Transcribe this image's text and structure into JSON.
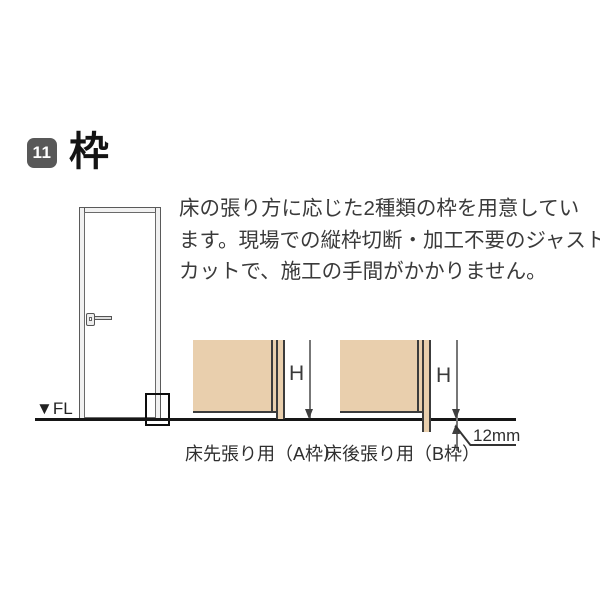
{
  "header": {
    "badge": "11",
    "title": "枠"
  },
  "intro": {
    "lines": [
      "床の張り方に応じた2種類の枠を用意してい",
      "ます。現場での縦枠切断・加工不要のジャスト",
      "カットで、施工の手間がかかりません。"
    ]
  },
  "floor": {
    "fl_label": "▼FL"
  },
  "diagram_a": {
    "label": "床先張り用（A枠）",
    "height_label": "H"
  },
  "diagram_b": {
    "label": "床後張り用（B枠）",
    "height_label": "H",
    "offset_label": "12mm"
  },
  "colors": {
    "wall-tan": "#e9cfad",
    "line-dark": "#3c3c3c",
    "floor-black": "#161616",
    "badge-gray": "#585858",
    "text-dark": "#333333",
    "dim-gray": "#777777"
  }
}
